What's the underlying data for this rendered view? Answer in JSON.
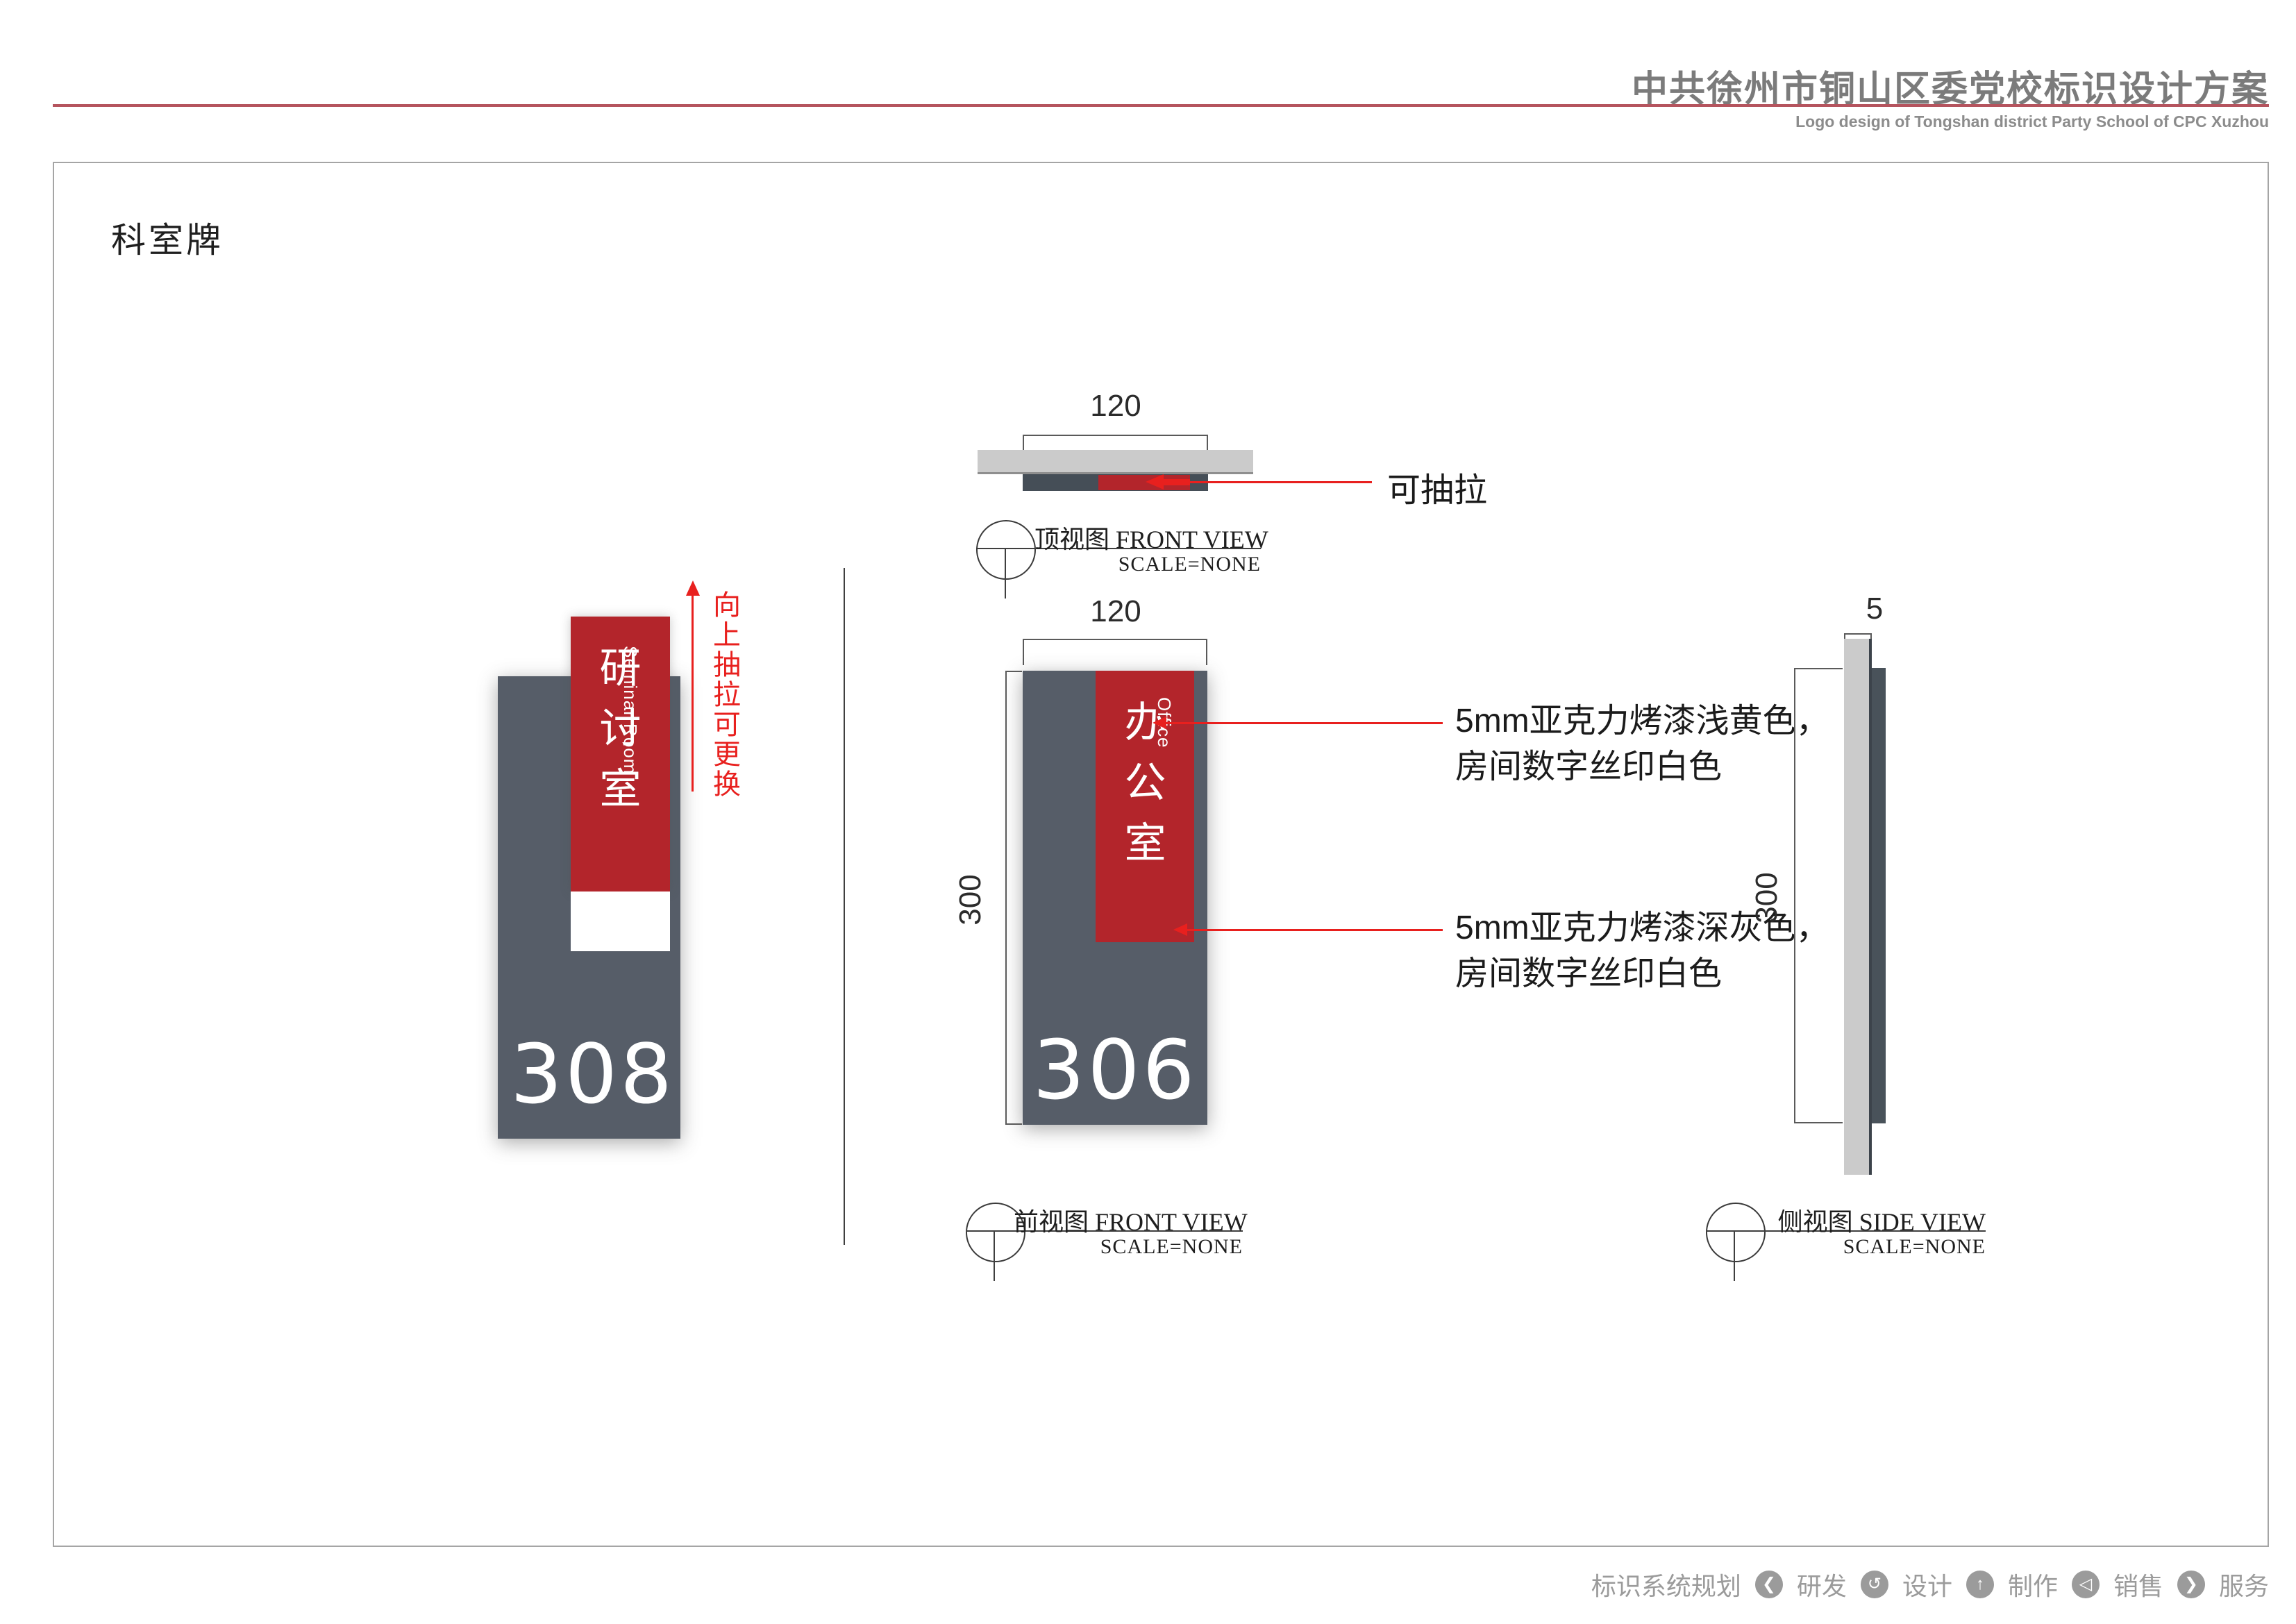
{
  "header": {
    "title": "中共徐州市铜山区委党校标识设计方案",
    "subtitle": "Logo design of Tongshan district Party School of CPC Xuzhou"
  },
  "section": {
    "title": "科室牌"
  },
  "signs": {
    "seminar": {
      "name_cn": "研讨室",
      "name_en": "Seminar Room",
      "number": "308"
    },
    "office": {
      "name_cn": "办公室",
      "name_en": "Office",
      "number": "306"
    }
  },
  "dimensions": {
    "width": "120",
    "height": "300",
    "thickness": "5"
  },
  "annotations": {
    "pull_up": "向上抽拉可更换",
    "pull_out": "可抽拉",
    "red_acrylic_line1": "5mm亚克力烤漆浅黄色，",
    "red_acrylic_line2": "房间数字丝印白色",
    "gray_acrylic_line1": "5mm亚克力烤漆深灰色，",
    "gray_acrylic_line2": "房间数字丝印白色"
  },
  "views": {
    "top": {
      "label_cn": "顶视图",
      "label_en": "FRONT VIEW",
      "scale": "SCALE=NONE"
    },
    "front": {
      "label_cn": "前视图",
      "label_en": "FRONT VIEW",
      "scale": "SCALE=NONE"
    },
    "side": {
      "label_cn": "侧视图",
      "label_en": "SIDE VIEW",
      "scale": "SCALE=NONE"
    }
  },
  "footer": {
    "items": [
      "标识系统规划",
      "研发",
      "设计",
      "制作",
      "销售",
      "服务"
    ],
    "icons": [
      {
        "name": "chevron-left-icon",
        "glyph": "❮"
      },
      {
        "name": "rotate-icon",
        "glyph": "↺"
      },
      {
        "name": "arrow-up-icon",
        "glyph": "↑"
      },
      {
        "name": "triangle-left-icon",
        "glyph": "◁"
      },
      {
        "name": "chevron-right-icon",
        "glyph": "❯"
      }
    ]
  },
  "colors": {
    "accent_red": "#b3252b",
    "bright_red": "#e8201e",
    "panel_gray": "#565d68",
    "dark_bar_gray": "#454e57",
    "wall_gray": "#cbcbcb",
    "header_gray": "#7b7b7b",
    "rule_red": "#b5545e"
  }
}
